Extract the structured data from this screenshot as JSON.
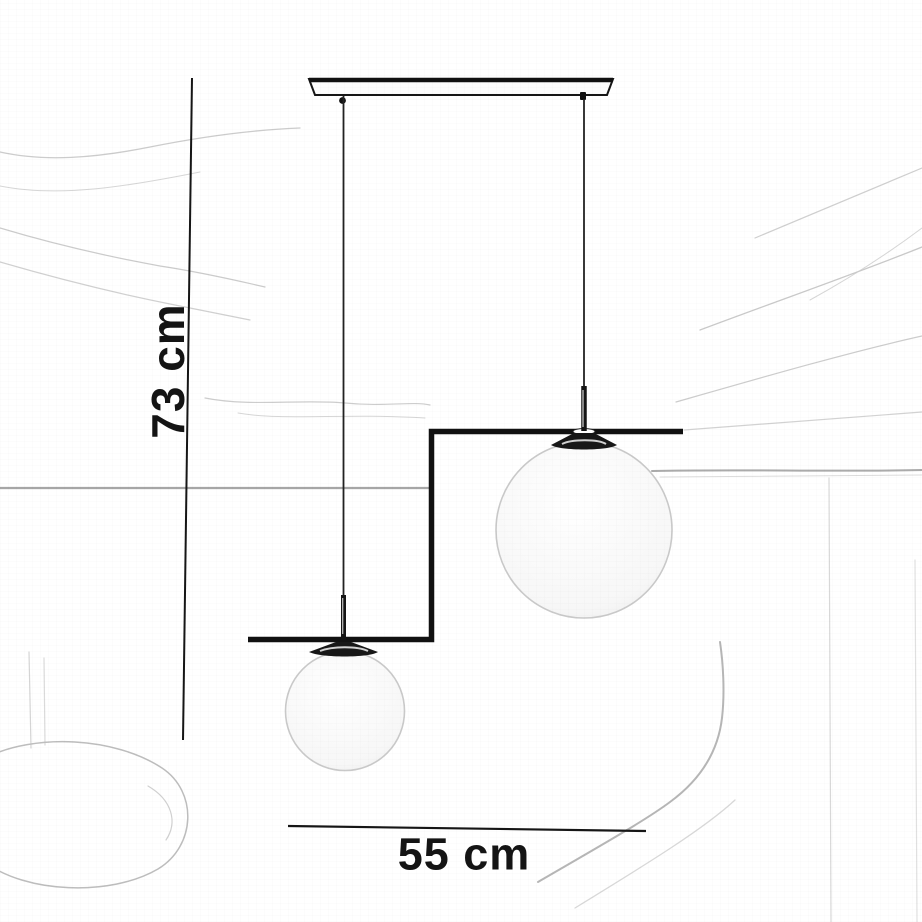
{
  "diagram": {
    "height_dimension": {
      "label": "73 cm"
    },
    "width_dimension": {
      "label": "55 cm"
    },
    "colors": {
      "ink": "#141414",
      "frame": "#111111",
      "globe_outline": "#c9c9c9",
      "sketch_line_light": "#cccccc",
      "sketch_line_mid": "#a8a8a8",
      "background": "#ffffff"
    }
  }
}
